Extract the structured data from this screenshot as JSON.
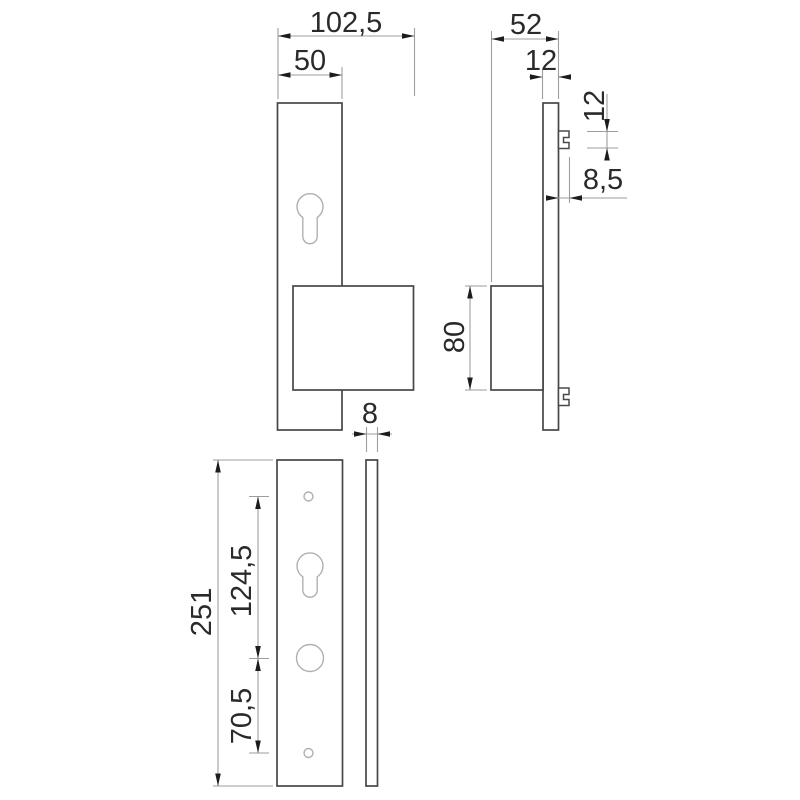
{
  "drawing": {
    "type": "technical-dimension-drawing",
    "subject": "door security plate with handle block, front and side views",
    "colors": {
      "background": "#ffffff",
      "part_outline": "#474747",
      "hole_outline": "#b0b0b0",
      "dimension_line": "#9e9e9e",
      "arrowhead": "#1c1c1c",
      "label_text": "#2a2a2a"
    },
    "dimensions": {
      "overall_width": "102,5",
      "plate_width": "50",
      "overall_depth": "52",
      "plate_thickness": "12",
      "clip_height": "12",
      "clip_protrusion": "8,5",
      "handle_block_height": "80",
      "back_plate_thickness": "8",
      "back_plate_height": "251",
      "upper_hole_spacing": "124,5",
      "lower_hole_spacing": "70,5"
    }
  }
}
